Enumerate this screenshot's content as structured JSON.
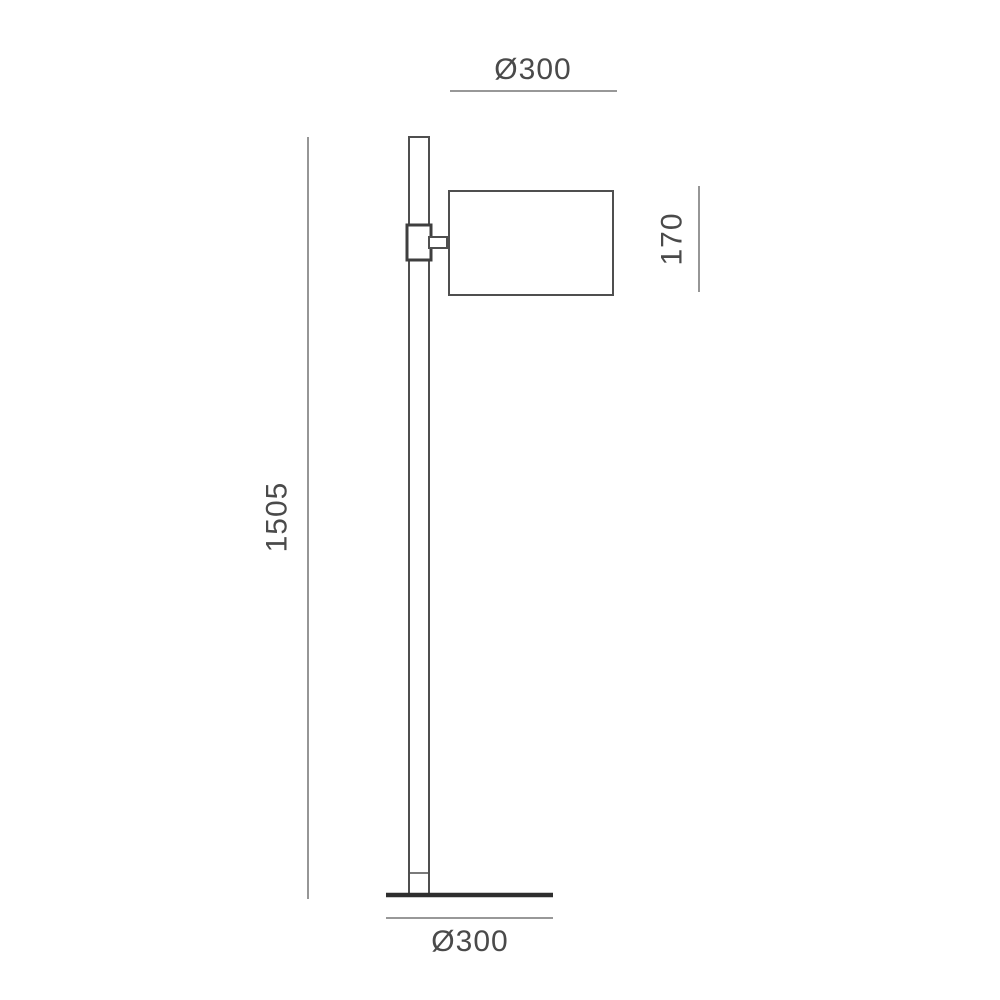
{
  "dimensions": {
    "shade_diameter_label": "Ø300",
    "shade_height_label": "170",
    "lamp_height_label": "1505",
    "base_diameter_label": "Ø300"
  },
  "colors": {
    "background": "#ffffff",
    "outline": "#4f4f4f",
    "dimension_line": "#8a8a8a",
    "dimension_text": "#4a4a4a",
    "base_line": "#2e2e2e"
  }
}
